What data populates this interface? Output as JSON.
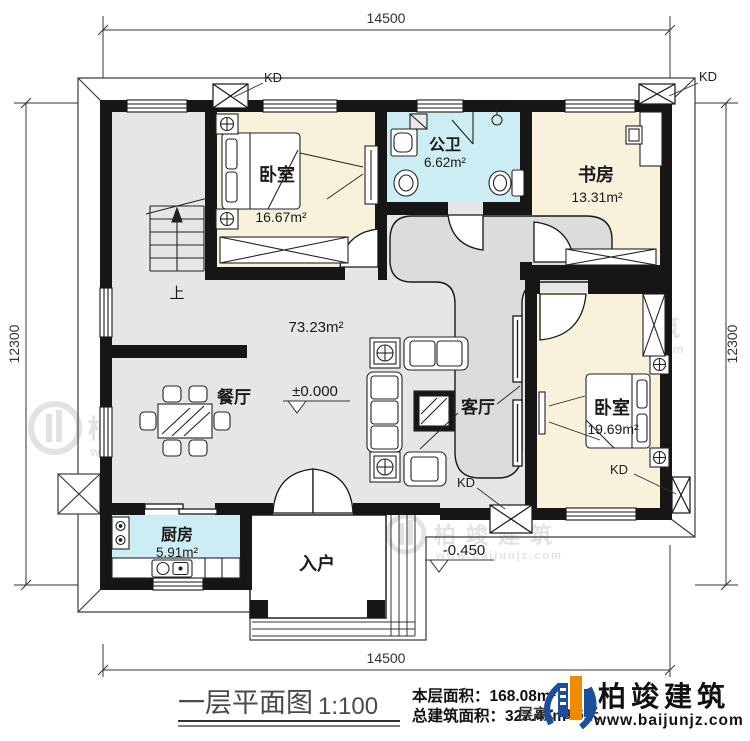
{
  "dims": {
    "width": "14500",
    "height": "12300"
  },
  "rooms": {
    "bedroom1": {
      "name": "卧室",
      "area": "16.67m²"
    },
    "bathroom": {
      "name": "公卫",
      "area": "6.62m²"
    },
    "study": {
      "name": "书房",
      "area": "13.31m²"
    },
    "hall": {
      "area": "73.23m²"
    },
    "dining": {
      "name": "餐厅"
    },
    "living": {
      "name": "客厅"
    },
    "bedroom2": {
      "name": "卧室",
      "area": "19.69m²"
    },
    "kitchen": {
      "name": "厨房",
      "area": "5.91m²"
    },
    "entry": {
      "name": "入户"
    }
  },
  "markers": {
    "kd": "KD",
    "level_main": "±0.000",
    "level_entry": "-0.450",
    "stair_up": "上"
  },
  "title_block": {
    "title": "一层平面图",
    "scale": "1:100",
    "floor_area": "本层面积：168.08m²",
    "total_area": "总建筑面积：327.46m²",
    "height_note": "层高：3.6米",
    "brand": "柏竣建筑",
    "website": "www.baijunjz.com"
  },
  "watermark": {
    "brand": "柏竣建筑",
    "website": "www.baijunjz.com"
  }
}
